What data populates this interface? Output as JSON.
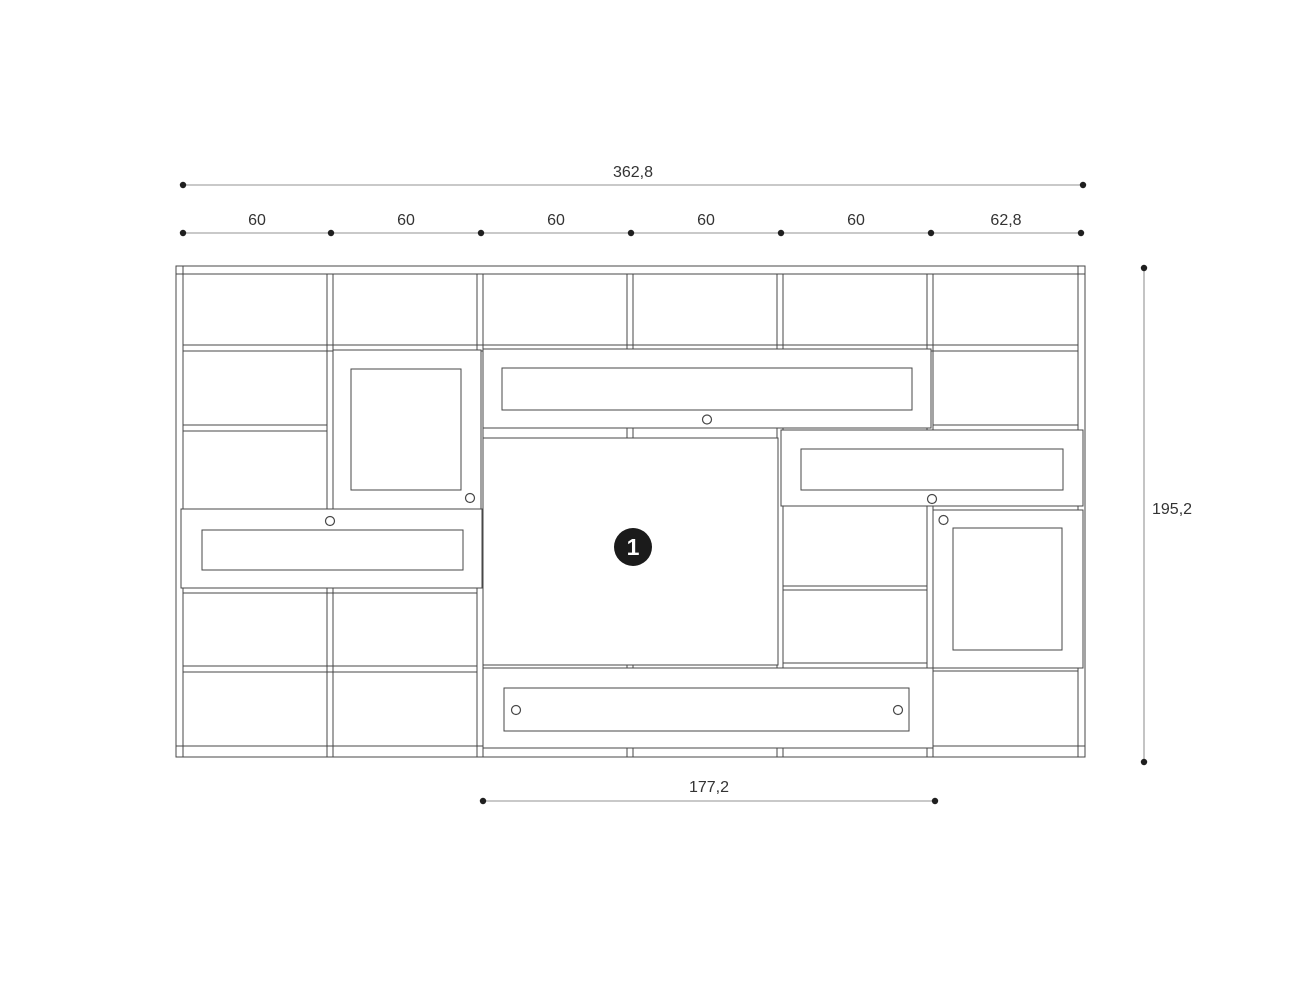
{
  "dimensions": {
    "total_width": "362,8",
    "segments": [
      "60",
      "60",
      "60",
      "60",
      "60",
      "62,8"
    ],
    "height": "195,2",
    "bottom_width": "177,2"
  },
  "badge": {
    "label": "1"
  },
  "colors": {
    "line": "#474747",
    "dimension_line": "#939393",
    "dot": "#1f1f1f",
    "text": "#333333",
    "badge_bg": "#1b1b1b",
    "badge_text": "#ffffff",
    "background": "#ffffff"
  }
}
